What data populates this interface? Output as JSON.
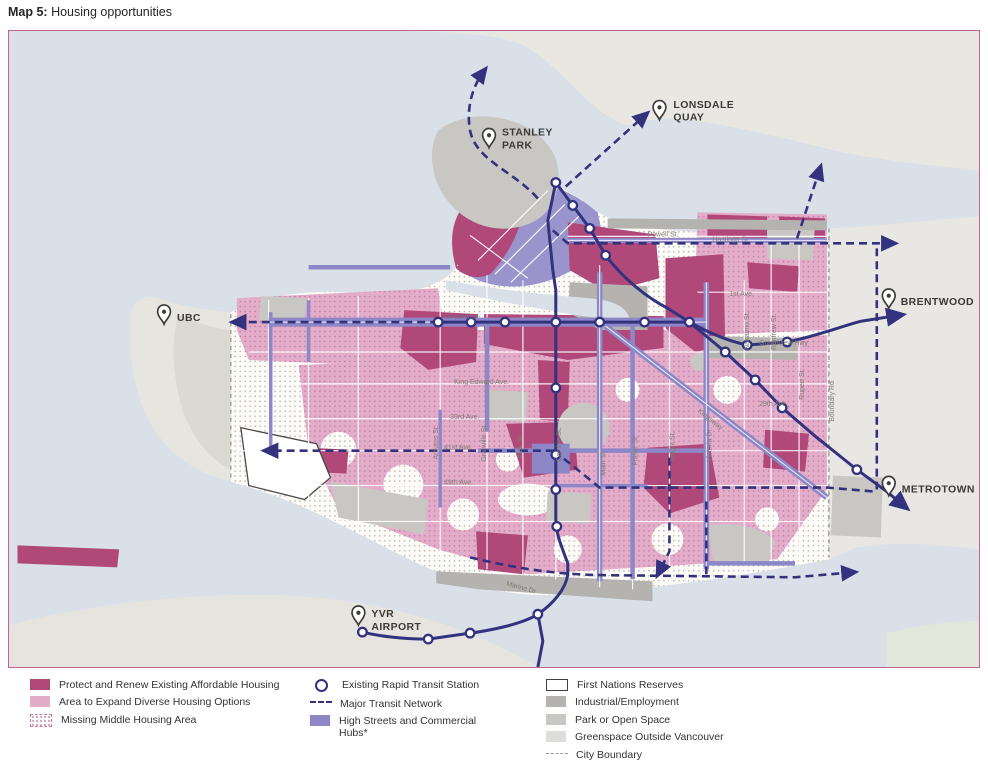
{
  "title": {
    "prefix": "Map 5:",
    "text": "Housing opportunities"
  },
  "map": {
    "landmarks": {
      "stanley_park": [
        "STANLEY",
        "PARK"
      ],
      "lonsdale_quay": [
        "LONSDALE",
        "QUAY"
      ],
      "ubc": [
        "UBC"
      ],
      "brentwood": [
        "BRENTWOOD"
      ],
      "metrotown": [
        "METROTOWN"
      ],
      "yvr": [
        "YVR",
        "AIRPORT"
      ]
    },
    "streets": {
      "powell": "Powell St.",
      "hastings": "Hastings St.",
      "first_ave": "1st Ave.",
      "broadway": "Broadway",
      "grandview": "Grandview Hwy",
      "king_edward": "King Edward Ave.",
      "ave33": "33rd Ave.",
      "ave41": "41st Ave.",
      "ave49": "49th Ave.",
      "ave29": "29th Ave.",
      "kingsway": "Kingsway",
      "marine": "Marine Dr",
      "arbutus": "Arbutus St.",
      "granville": "Granville St.",
      "oak": "Oak St.",
      "cambie": "Cambie St.",
      "main": "Main St.",
      "fraser": "Fraser St.",
      "knight": "Knight St.",
      "victoria": "Victoria Dr.",
      "nanaimo": "Nanaimo St.",
      "renfrew": "Renfrew St.",
      "rupert": "Rupert St.",
      "boundary": "Boundary Rd."
    }
  },
  "legend": {
    "housing": [
      {
        "label": "Protect and Renew Existing Affordable Housing",
        "swatch": "crimson"
      },
      {
        "label": "Area to Expand Diverse Housing Options",
        "swatch": "pink"
      },
      {
        "label": "Missing Middle Housing Area",
        "swatch": "dotted"
      }
    ],
    "transit": [
      {
        "label": "Existing Rapid Transit Station",
        "swatch": "station"
      },
      {
        "label": "Major Transit Network",
        "swatch": "dashed-navy"
      },
      {
        "label": "High Streets and Commercial Hubs*",
        "swatch": "purple"
      }
    ],
    "land": [
      {
        "label": "First Nations Reserves",
        "swatch": "white-outline"
      },
      {
        "label": "Industrial/Employment",
        "swatch": "dark-gray"
      },
      {
        "label": "Park or Open Space",
        "swatch": "mid-gray"
      },
      {
        "label": "Greenspace Outside Vancouver",
        "swatch": "light-gray"
      },
      {
        "label": "City Boundary",
        "swatch": "dashed-gray"
      }
    ]
  },
  "colors": {
    "protect_renew": "#b0487a",
    "expand_diverse": "#e3adc9",
    "high_streets": "#8d87c7",
    "transit_navy": "#32327e",
    "water": "#d9e0e8",
    "industrial": "#b4b3b0",
    "park_gray": "#c9c7c3",
    "greenspace": "#e7e5e0",
    "boundary_dash": "#9a9a9a",
    "map_border": "#bd6590"
  }
}
